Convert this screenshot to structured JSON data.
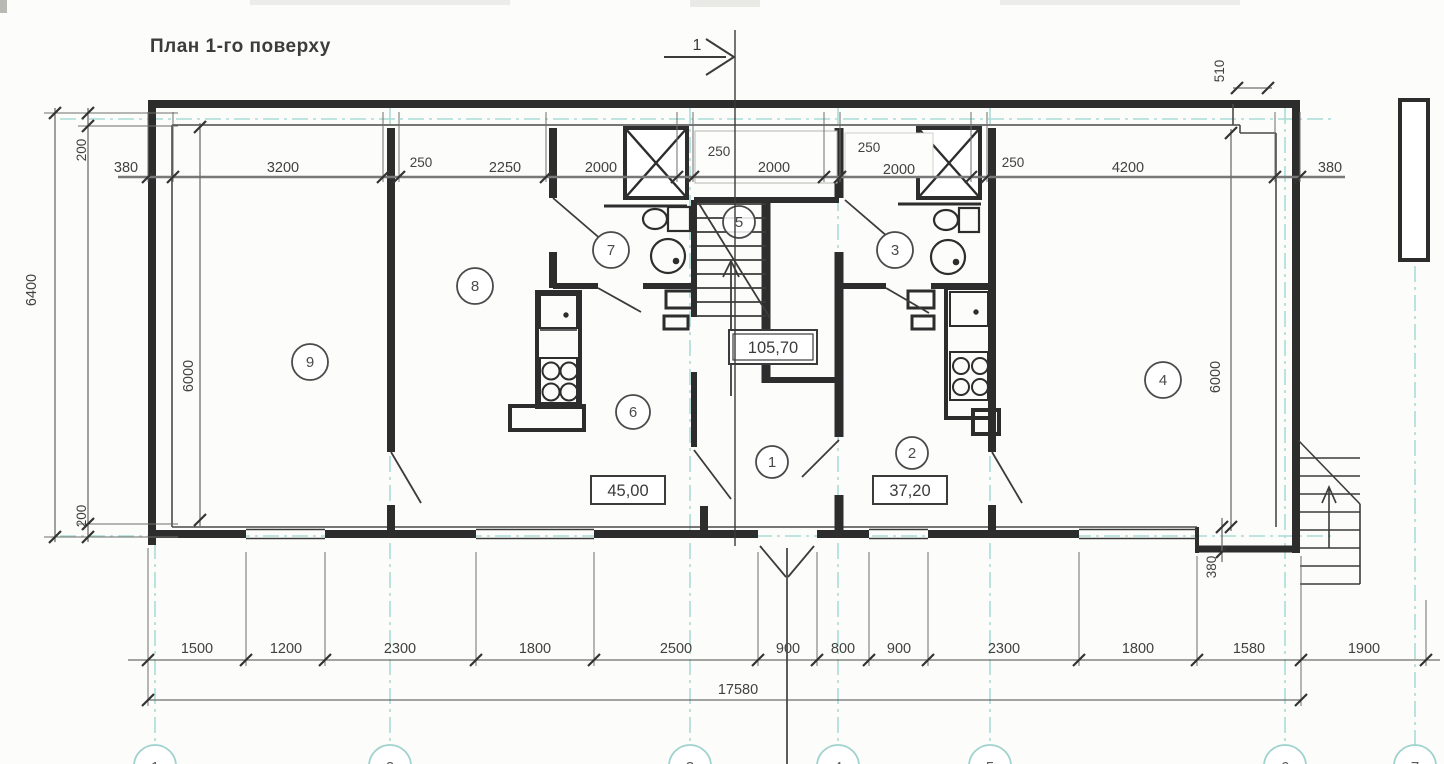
{
  "title": "План 1-го поверху",
  "section_label": "1",
  "dims": {
    "top": [
      "380",
      "3200",
      "250",
      "2250",
      "2000",
      "250",
      "2000",
      "250",
      "2000",
      "250",
      "4200",
      "380"
    ],
    "bottom": [
      "1500",
      "1200",
      "2300",
      "1800",
      "2500",
      "900",
      "800",
      "900",
      "2300",
      "1800",
      "1580",
      "1900"
    ],
    "total": "17580",
    "left_overall": "6400",
    "left_top": "200",
    "left_bottom": "200",
    "left_inner": "6000",
    "right_inner": "6000",
    "right_top": "510",
    "right_bottom": "380"
  },
  "areas": {
    "total": "105,70",
    "left_unit": "45,00",
    "right_unit": "37,20"
  },
  "rooms": [
    "1",
    "2",
    "3",
    "4",
    "5",
    "6",
    "7",
    "8",
    "9"
  ],
  "axes": [
    "1",
    "2",
    "3",
    "4",
    "5",
    "6",
    "7"
  ],
  "colors": {
    "ink": "#3b3b3b",
    "wall": "#2d2d2d",
    "axis_line": "#a9dcd7",
    "paper": "#fcfcfb"
  }
}
